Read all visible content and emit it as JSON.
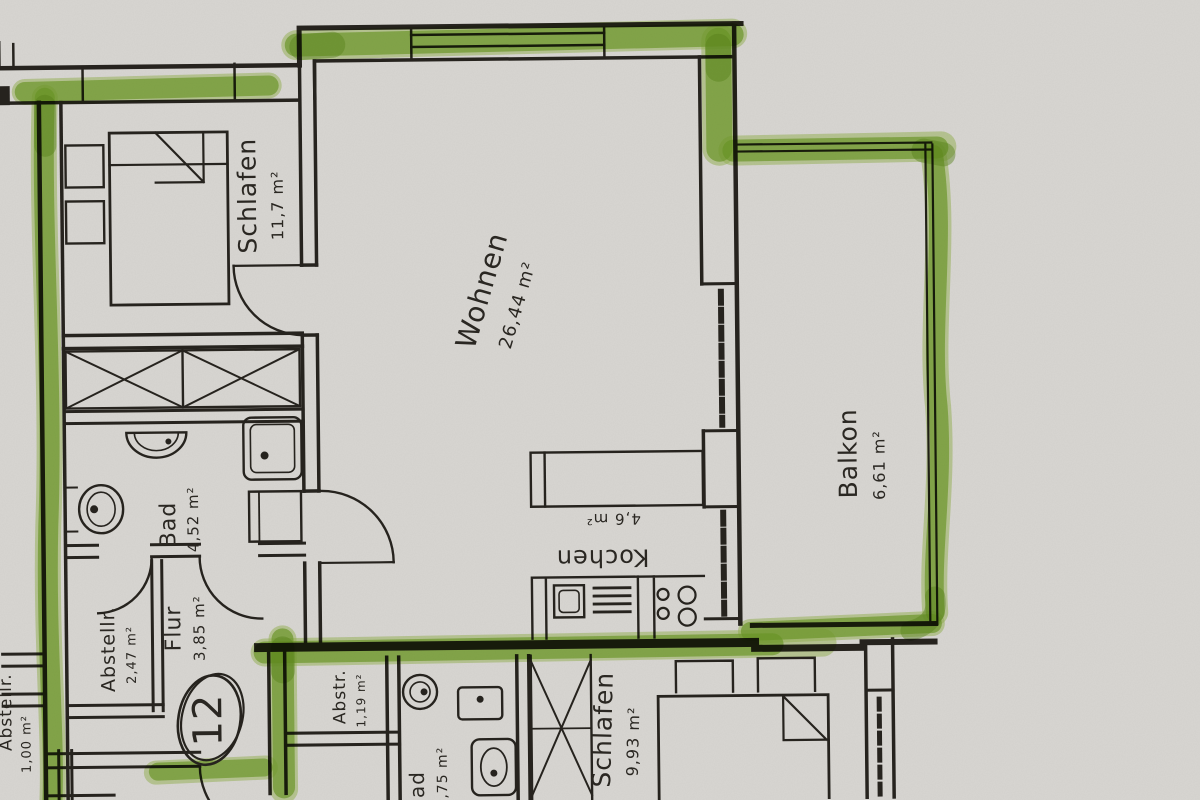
{
  "plan": {
    "paper_color": "#d8d6d2",
    "ink_color": "#26231e",
    "highlighter_color": "#7db32f",
    "unit_number": "12",
    "rooms": {
      "schlafen": {
        "name": "Schlafen",
        "area": "11,7 m²"
      },
      "wohnen": {
        "name": "Wohnen",
        "area": "26,44 m²"
      },
      "balkon": {
        "name": "Balkon",
        "area": "6,61 m²"
      },
      "kochen": {
        "name": "Kochen",
        "area": "4,6 m²"
      },
      "bad": {
        "name": "Bad",
        "area": "4,52 m²"
      },
      "flur": {
        "name": "Flur",
        "area": "3,85 m²"
      },
      "abstellraum": {
        "name": "Abstellr.",
        "area": "2,47 m²"
      },
      "edge_abstell": {
        "name": "Abstellr.",
        "area": "1,00 m²"
      },
      "neighbor_abstell": {
        "name": "Abstr.",
        "area": "1,19 m²"
      },
      "neighbor_bad": {
        "name": "Bad",
        "area": "4,75 m²"
      },
      "neighbor_schlafen": {
        "name": "Schlafen",
        "area": "9,93 m²"
      }
    }
  }
}
